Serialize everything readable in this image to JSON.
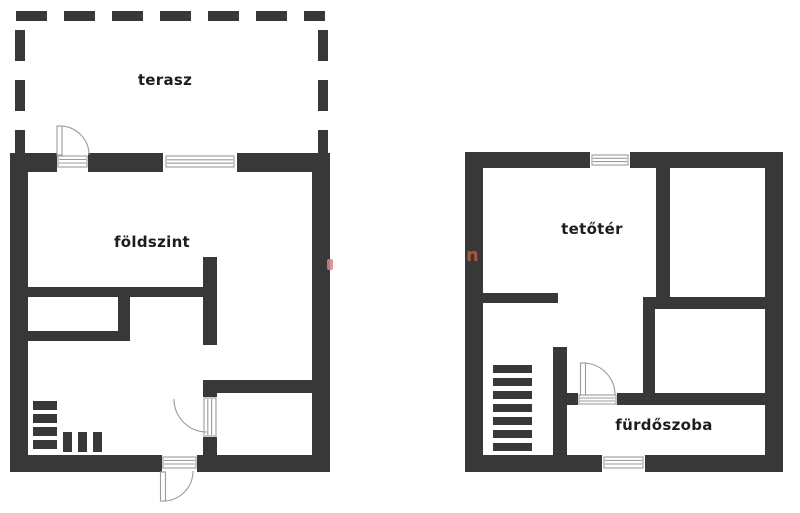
{
  "colors": {
    "wall": "#383838",
    "outline": "#9b9b9b",
    "text": "#1d1d1d",
    "background": "#ffffff",
    "watermark_orange": "#a9573b",
    "watermark_pink": "#d38686"
  },
  "rooms": {
    "terrace": "terasz",
    "ground_floor": "földszint",
    "attic": "tetőtér",
    "bathroom": "fürdőszoba"
  },
  "watermark": {
    "letter": "n"
  },
  "icons": {
    "terrace_outline": "dashed-outline-icon",
    "door": "door-swing-icon",
    "window": "window-icon",
    "stairs": "stairs-icon"
  }
}
